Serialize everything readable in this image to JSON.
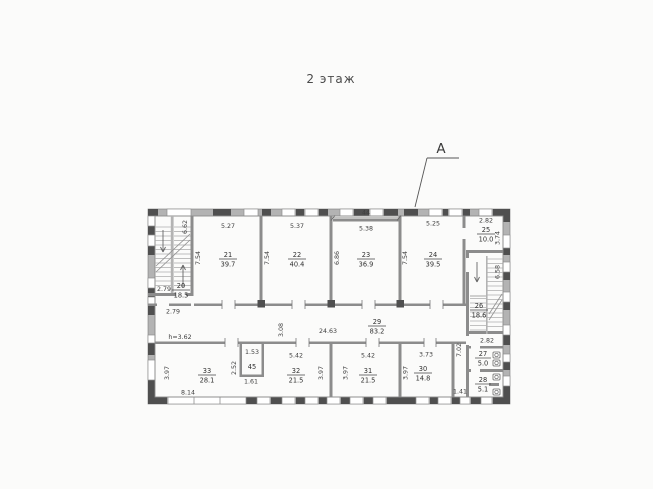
{
  "title": "2 этаж",
  "section_marker": "A",
  "corridor": {
    "height_note": "h=3.62"
  },
  "rooms": {
    "r20": {
      "num": "20",
      "area": "18.5"
    },
    "r21": {
      "num": "21",
      "area": "39.7"
    },
    "r22": {
      "num": "22",
      "area": "40.4"
    },
    "r23": {
      "num": "23",
      "area": "36.9"
    },
    "r24": {
      "num": "24",
      "area": "39.5"
    },
    "r25": {
      "num": "25",
      "area": "10.0"
    },
    "r26": {
      "num": "26",
      "area": "18.6"
    },
    "r27": {
      "num": "27",
      "area": "5.0"
    },
    "r28": {
      "num": "28",
      "area": "5.1"
    },
    "r29": {
      "num": "29",
      "area": "83.2"
    },
    "r30": {
      "num": "30",
      "area": "14.8"
    },
    "r31": {
      "num": "31",
      "area": "21.5"
    },
    "r32": {
      "num": "32",
      "area": "21.5"
    },
    "r33": {
      "num": "33",
      "area": "28.1"
    },
    "r45": {
      "num": "45"
    }
  },
  "dims": {
    "d_2_79": "2.79",
    "d_6_62": "6.62",
    "d_5_27": "5.27",
    "d_5_37": "5.37",
    "d_44": "44",
    "d_5_38": "5.38",
    "d_5_25": "5.25",
    "d_2_82": "2.82",
    "d_7_54": "7.54",
    "d_6_86": "6.86",
    "d_3_74": "3.74",
    "d_6_58": "6.58",
    "d_3_08": "3.08",
    "d_24_63": "24.63",
    "d_3_97": "3.97",
    "d_8_14": "8.14",
    "d_1_53": "1.53",
    "d_2_52": "2.52",
    "d_1_61": "1.61",
    "d_5_42": "5.42",
    "d_3_73": "3.73",
    "d_7_02": "7.02",
    "d_1_41": "1.41"
  },
  "colors": {
    "wall_dark": "#4f4f4f",
    "wall_light": "#b3b3b3",
    "partition": "#8c8c8c",
    "background": "#fbfbfa"
  }
}
